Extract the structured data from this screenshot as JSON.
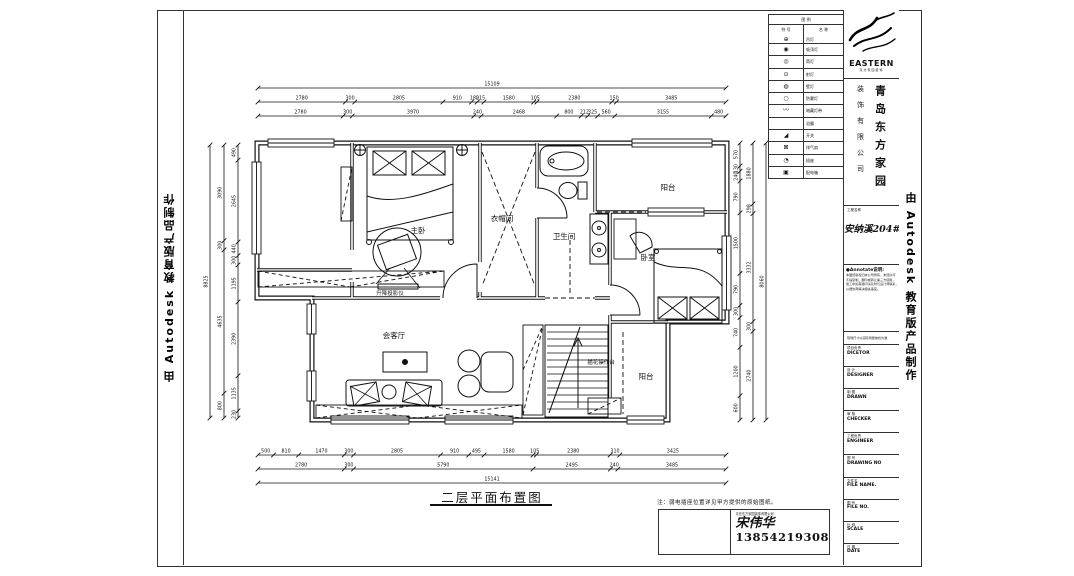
{
  "watermark": "由 Autodesk 教育版产品制作",
  "legend": {
    "header1": "图 例",
    "header2_sym": "符 号",
    "header2_name": "名 称",
    "rows": [
      {
        "sym": "⊕",
        "label": "吊灯"
      },
      {
        "sym": "◉",
        "label": "吸顶灯"
      },
      {
        "sym": "◎",
        "label": "筒灯"
      },
      {
        "sym": "⊙",
        "label": "射灯"
      },
      {
        "sym": "◍",
        "label": "壁灯"
      },
      {
        "sym": "○",
        "label": "防雾灯"
      },
      {
        "sym": "〰",
        "label": "暗藏灯带"
      },
      {
        "sym": "",
        "label": "浴霸"
      },
      {
        "sym": "◢",
        "label": "开关"
      },
      {
        "sym": "⊠",
        "label": "排气扇"
      },
      {
        "sym": "◔",
        "label": "插座"
      },
      {
        "sym": "▣",
        "label": "配电箱"
      }
    ]
  },
  "title_block": {
    "logo_text": "EASTERN",
    "logo_sub": "东方家园装饰",
    "company_line1": "青岛东方家园",
    "company_line2": "装饰有限公司",
    "project_label": "工程名称",
    "project_name": "安纳溪204#",
    "annotate_title": "●Annotate说明:",
    "annotate_lines": [
      "本图纸版权归本公司所有，未经许可",
      "不得复制、翻印或转让第三方使用。",
      "施工中如有疑问请及时与设计师联系，",
      "以便协商解决相关事宜。"
    ],
    "note_line": "现场尺寸以实际测量放线为准",
    "rows": [
      {
        "cn": "项目负责",
        "en": "DICETOR"
      },
      {
        "cn": "设 计",
        "en": "DESIGNER"
      },
      {
        "cn": "制 图",
        "en": "DRAWN"
      },
      {
        "cn": "审 核",
        "en": "CHECKER"
      },
      {
        "cn": "工程负责",
        "en": "ENGINEER"
      },
      {
        "cn": "图 号",
        "en": "DRAWING NO"
      },
      {
        "cn": "文件名",
        "en": "FILE NAME."
      },
      {
        "cn": "图 号",
        "en": "FILE NO."
      },
      {
        "cn": "比 例",
        "en": "SCALE"
      },
      {
        "cn": "日 期",
        "en": "DATE"
      }
    ]
  },
  "rooms": {
    "master_bedroom": "主卧",
    "cloakroom": "衣帽间",
    "bathroom": "卫生间",
    "balcony_top": "阳台",
    "bedroom": "卧室",
    "living_room": "会客厅",
    "flower_table": "插花操作台",
    "balcony_bottom": "阳台",
    "projector": "升降投影仪"
  },
  "dimensions": {
    "top": {
      "total": [
        15109
      ],
      "row2": [
        2780,
        300,
        2805,
        910,
        180,
        215,
        1580,
        105,
        2380,
        150,
        3485
      ],
      "row3": [
        2780,
        300,
        3970,
        240,
        2468,
        800,
        212,
        325,
        560,
        3155,
        480
      ]
    },
    "bottom": {
      "row1": [
        500,
        810,
        1470,
        300,
        2805,
        910,
        495,
        1580,
        105,
        2380,
        310,
        3425
      ],
      "row2": [
        2780,
        300,
        5790,
        2495,
        240,
        3485
      ],
      "total": [
        15141
      ]
    },
    "left": {
      "total": [
        8825
      ],
      "mid": [
        3090,
        300,
        4635,
        800
      ],
      "inner": [
        490,
        2645,
        440,
        300,
        1195,
        2390,
        1135,
        230
      ]
    },
    "right": {
      "total": [
        8060
      ],
      "mid": [
        1880,
        298,
        3332,
        300,
        2740
      ],
      "inner": [
        570,
        130,
        240,
        790,
        1500,
        790,
        300,
        740,
        1200,
        600
      ]
    }
  },
  "footer": {
    "drawing_title": "二层平面布置图",
    "note": "注：弱电插座位置详见甲方提供的原始图纸。",
    "sig_small": "青岛东方家园装饰有限公司",
    "sig_name": "宋伟华",
    "sig_phone": "13854219308"
  }
}
